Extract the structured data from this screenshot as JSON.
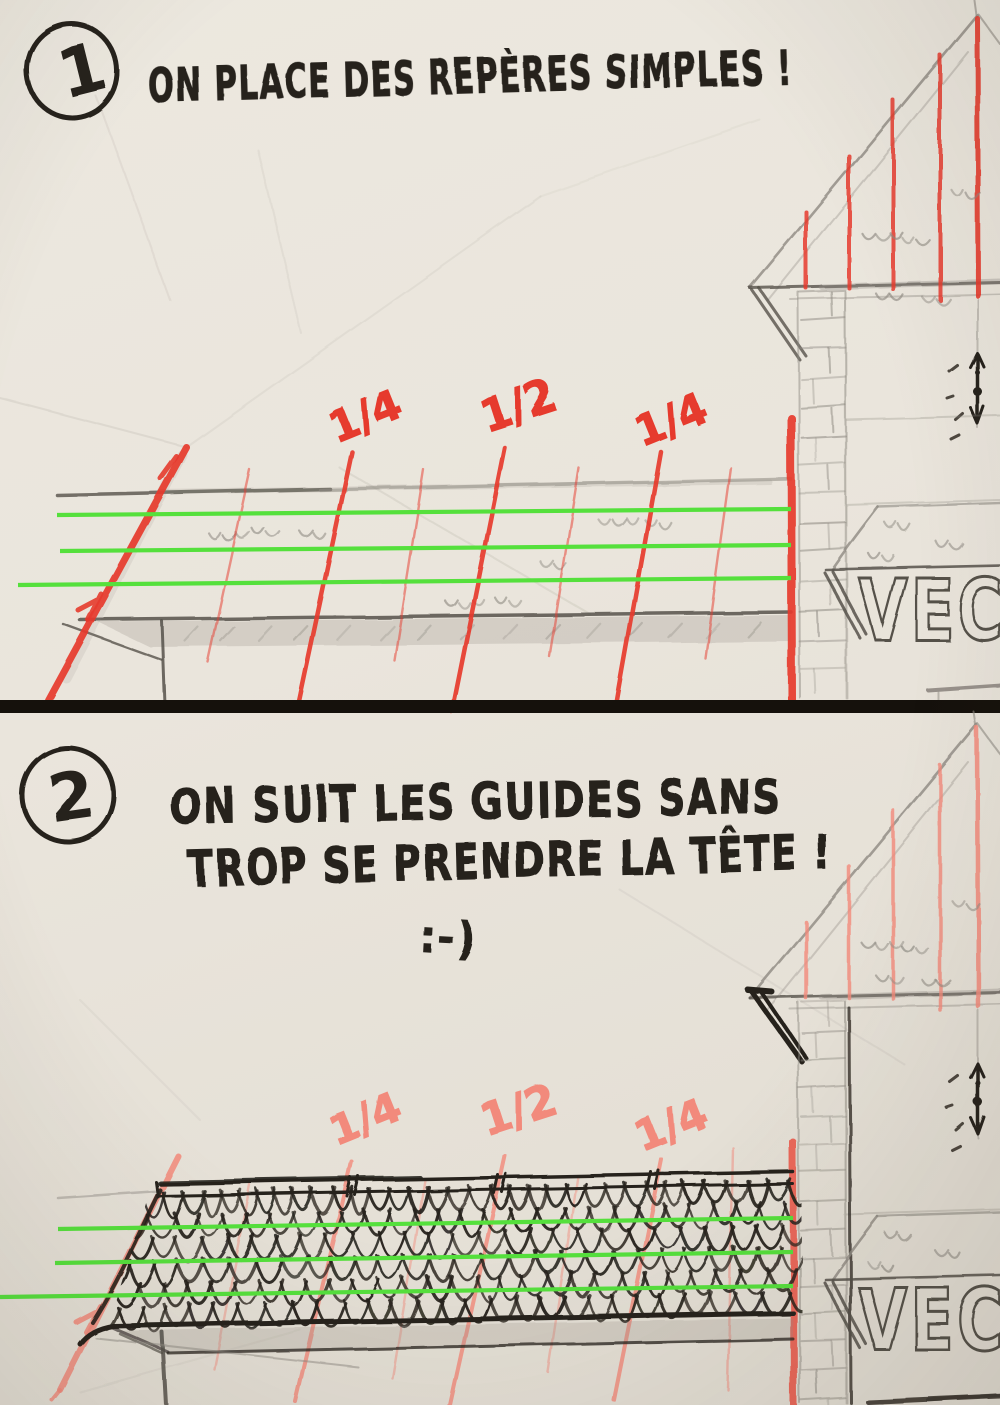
{
  "palette": {
    "paper": "#eae5dc",
    "paper_edge": "#ded8cd",
    "ink": "#26221c",
    "pencil": "#8e8a82",
    "pencil_dark": "#55514a",
    "marker_red": "#e63a2d",
    "marker_red_bright": "#ec4a3c",
    "marker_red_faded": "#f28a7b",
    "guide_green": "#55e03c",
    "divider": "#15110c",
    "shade_gray": "#9a958c"
  },
  "panel1": {
    "step_number": "1",
    "title": "ON PLACE DES REPÈRES SIMPLES !",
    "fractions": [
      "1/4",
      "1/2",
      "1/4"
    ],
    "sign_text": "VECO"
  },
  "panel2": {
    "step_number": "2",
    "title_line1": "ON SUIT LES GUIDES SANS",
    "title_line2": "TROP SE PRENDRE LA TÊTE !",
    "smiley": ":-)",
    "fractions": [
      "1/4",
      "1/2",
      "1/4"
    ],
    "sign_text": "VECO"
  }
}
